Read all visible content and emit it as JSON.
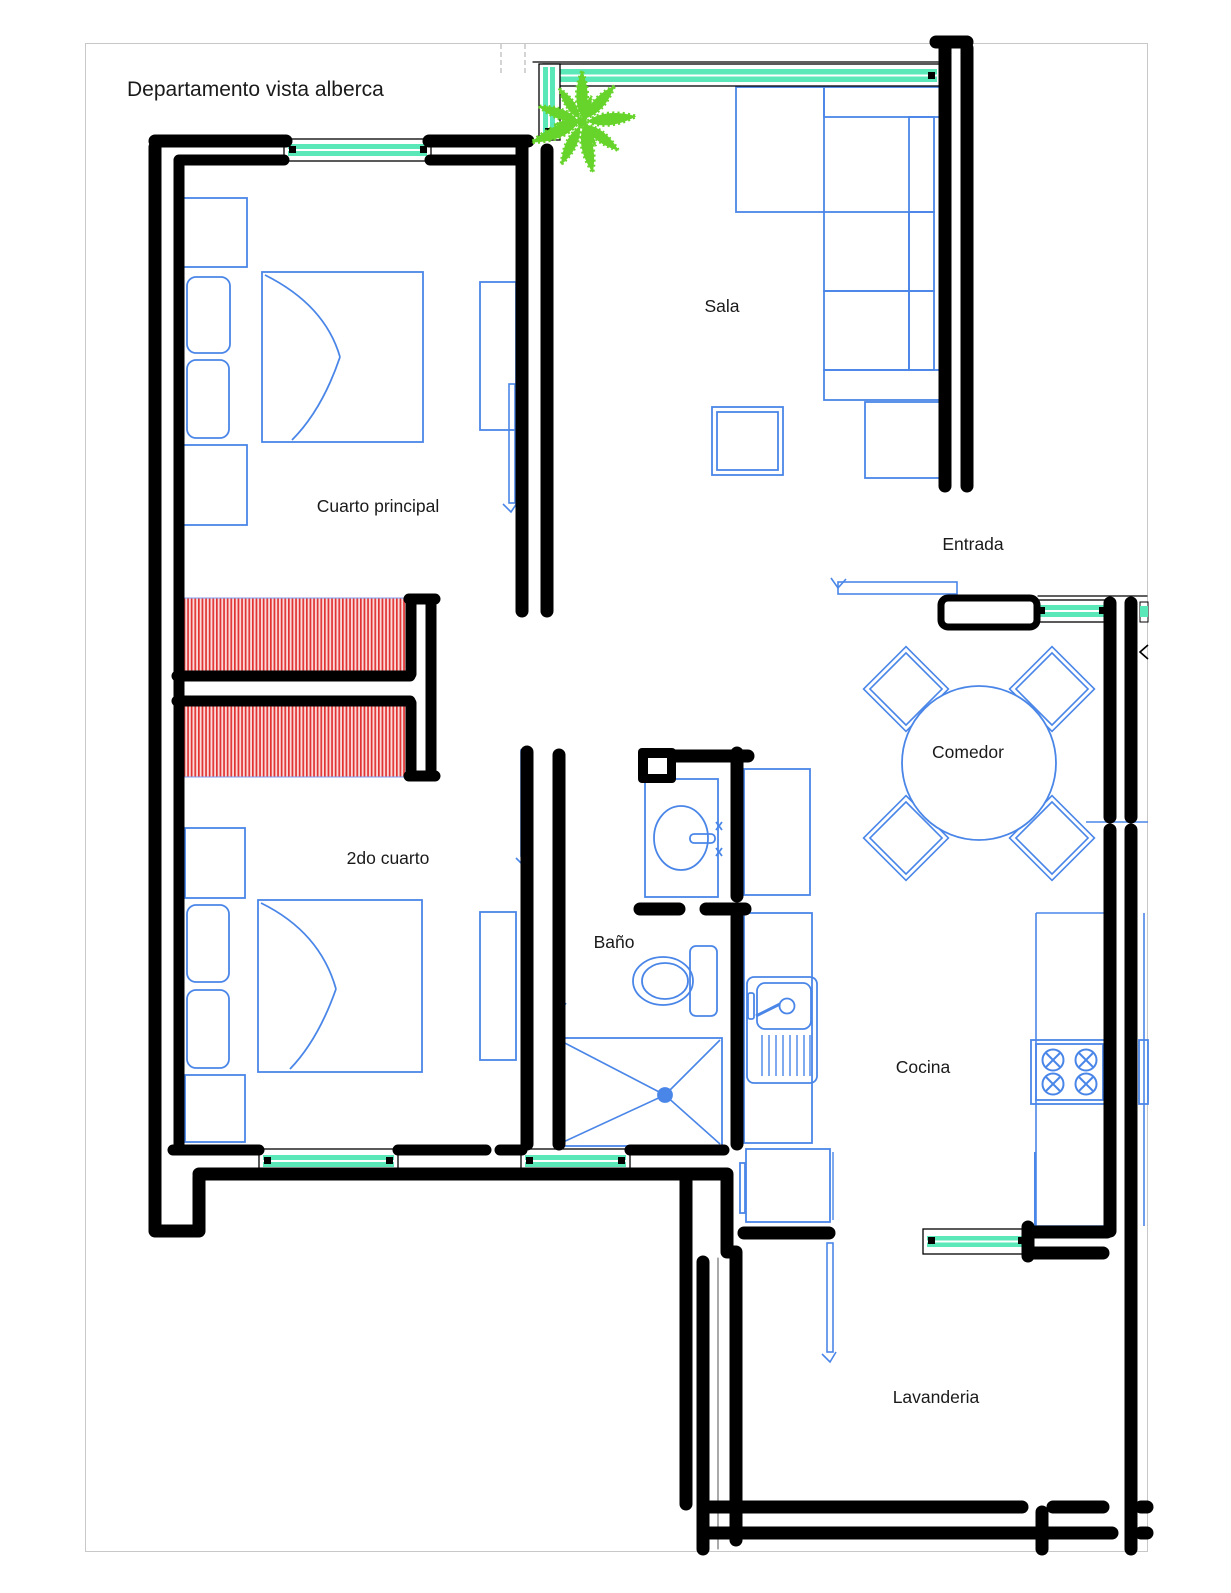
{
  "title": "Departamento vista alberca",
  "plan": {
    "rooms": [
      {
        "name": "Sala"
      },
      {
        "name": "Cuarto principal"
      },
      {
        "name": "Entrada"
      },
      {
        "name": "Comedor"
      },
      {
        "name": "2do cuarto"
      },
      {
        "name": "Baño"
      },
      {
        "name": "Cocina"
      },
      {
        "name": "Lavanderia"
      }
    ],
    "features": [
      "double-bed",
      "nightstand",
      "pillow",
      "dresser",
      "closet-hatch",
      "sectional-sofa",
      "coffee-table",
      "side-table",
      "fern-plant",
      "round-dining-table",
      "dining-chair",
      "bathroom-sink",
      "toilet",
      "shower",
      "kitchen-sink",
      "kitchen-counter",
      "stove-4-burners",
      "refrigerator",
      "window",
      "door-leaf",
      "wall-duct"
    ]
  },
  "colors": {
    "walls": "#000000",
    "furniture": "#4a86e8",
    "windows": "#5be8b9",
    "closet_hatch": "#e23333",
    "closet_background": "#fbd9d9",
    "plant": "#66d42a",
    "page_border": "#c8c8c8",
    "text": "#1a1a1a"
  }
}
